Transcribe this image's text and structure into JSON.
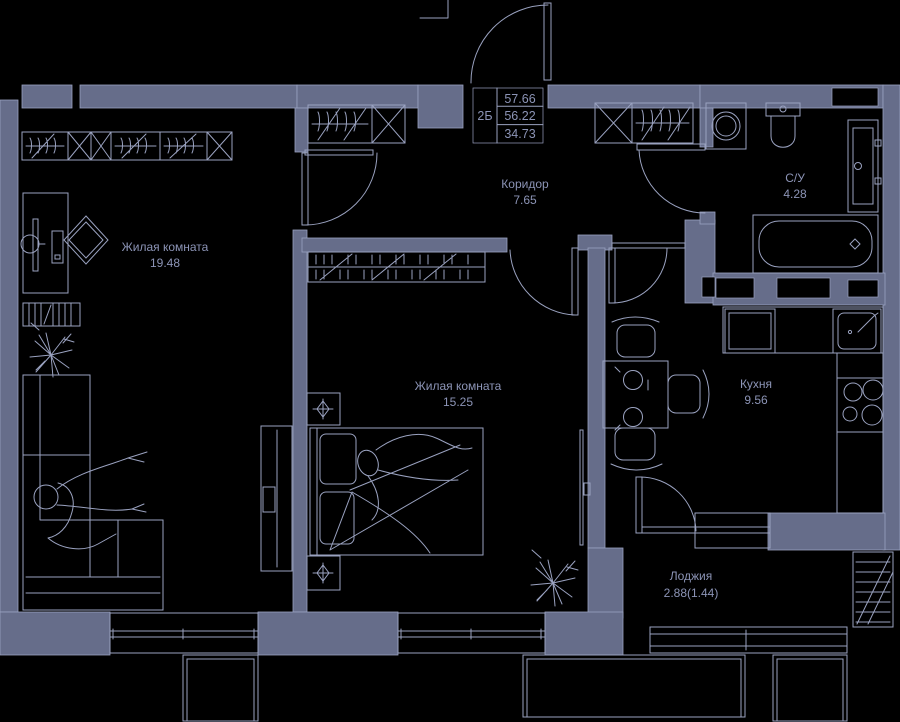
{
  "plan": {
    "unit_label": "2Б",
    "areas": {
      "total": "57.66",
      "reduced": "56.22",
      "living": "34.73"
    },
    "rooms": [
      {
        "name": "Жилая комната",
        "area": "19.48"
      },
      {
        "name": "Жилая комната",
        "area": "15.25"
      },
      {
        "name": "Коридор",
        "area": "7.65"
      },
      {
        "name": "С/У",
        "area": "4.28"
      },
      {
        "name": "Кухня",
        "area": "9.56"
      },
      {
        "name": "Лоджия",
        "area": "2.88(1.44)"
      }
    ],
    "colors": {
      "background": "#000000",
      "wall": "#666d8a",
      "line": "#9aa2c0",
      "text": "#8c94b6"
    }
  }
}
